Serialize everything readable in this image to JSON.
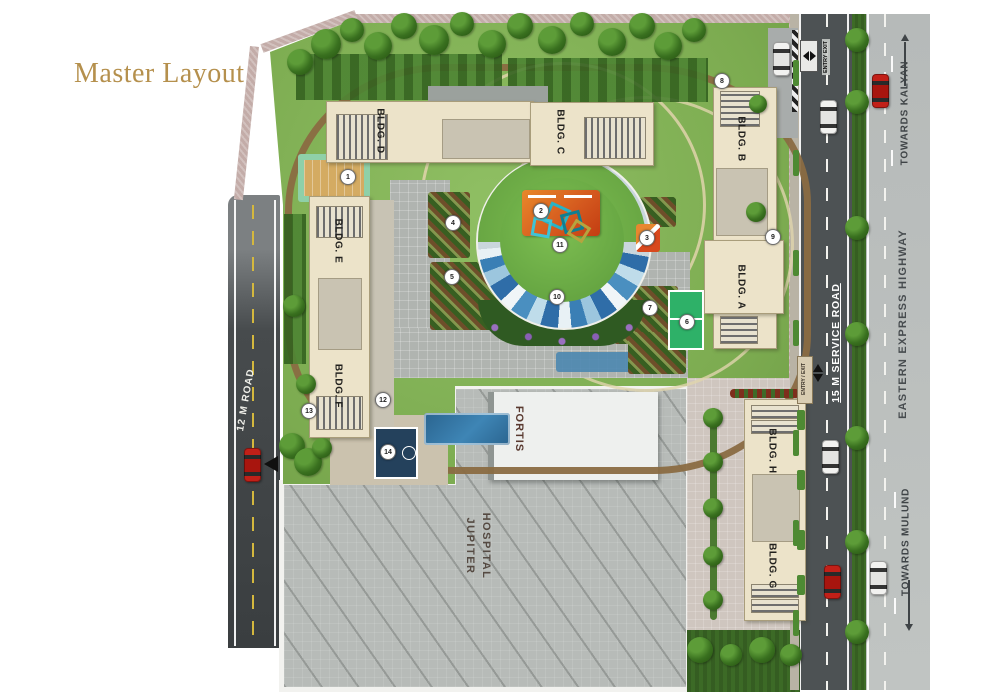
{
  "title": "Master Layout",
  "plan": {
    "buildings": [
      {
        "id": "A",
        "label": "BLDG. A"
      },
      {
        "id": "B",
        "label": "BLDG. B"
      },
      {
        "id": "C",
        "label": "BLDG. C"
      },
      {
        "id": "D",
        "label": "BLDG. D"
      },
      {
        "id": "E",
        "label": "BLDG. E"
      },
      {
        "id": "F",
        "label": "BLDG. F"
      },
      {
        "id": "G",
        "label": "BLDG. G"
      },
      {
        "id": "H",
        "label": "BLDG. H"
      }
    ],
    "roads": {
      "west": "12 M ROAD",
      "service": "15 M SERVICE ROAD",
      "highway": "EASTERN EXPRESS HIGHWAY"
    },
    "directions": {
      "north": "TOWARDS KALYAN",
      "south": "TOWARDS MULUND"
    },
    "entries": {
      "northeast": "ENTRY EXIT",
      "east": "ENTRY / EXIT"
    },
    "landmarks": {
      "fortis": "FORTIS",
      "hospital_line1": "JUPITER",
      "hospital_line2": "HOSPITAL"
    },
    "markers": [
      {
        "n": "1",
        "x": 348,
        "y": 177
      },
      {
        "n": "2",
        "x": 541,
        "y": 211
      },
      {
        "n": "3",
        "x": 647,
        "y": 238
      },
      {
        "n": "4",
        "x": 453,
        "y": 223
      },
      {
        "n": "5",
        "x": 452,
        "y": 277
      },
      {
        "n": "6",
        "x": 687,
        "y": 322
      },
      {
        "n": "7",
        "x": 650,
        "y": 308
      },
      {
        "n": "8",
        "x": 722,
        "y": 81
      },
      {
        "n": "9",
        "x": 773,
        "y": 237
      },
      {
        "n": "10",
        "x": 557,
        "y": 297
      },
      {
        "n": "11",
        "x": 560,
        "y": 245
      },
      {
        "n": "12",
        "x": 383,
        "y": 400
      },
      {
        "n": "13",
        "x": 309,
        "y": 411
      },
      {
        "n": "14",
        "x": 388,
        "y": 452
      }
    ],
    "vehicles": [
      {
        "color": "red",
        "x": 244,
        "y": 448
      },
      {
        "color": "white",
        "x": 820,
        "y": 100
      },
      {
        "color": "white",
        "x": 822,
        "y": 440
      },
      {
        "color": "red",
        "x": 824,
        "y": 565
      },
      {
        "color": "white",
        "x": 773,
        "y": 42
      },
      {
        "color": "red",
        "x": 872,
        "y": 74
      },
      {
        "color": "white",
        "x": 870,
        "y": 561
      }
    ],
    "colors": {
      "title": "#b5904d",
      "building": "#ece3c9",
      "lawn": "#86b85c",
      "service_road": "#4d5254",
      "highway": "#b9bdbc",
      "hospital": "#b7bbb8",
      "amphitheatre_blue": "#3a7fb5",
      "wall": "#c3aca8"
    }
  }
}
